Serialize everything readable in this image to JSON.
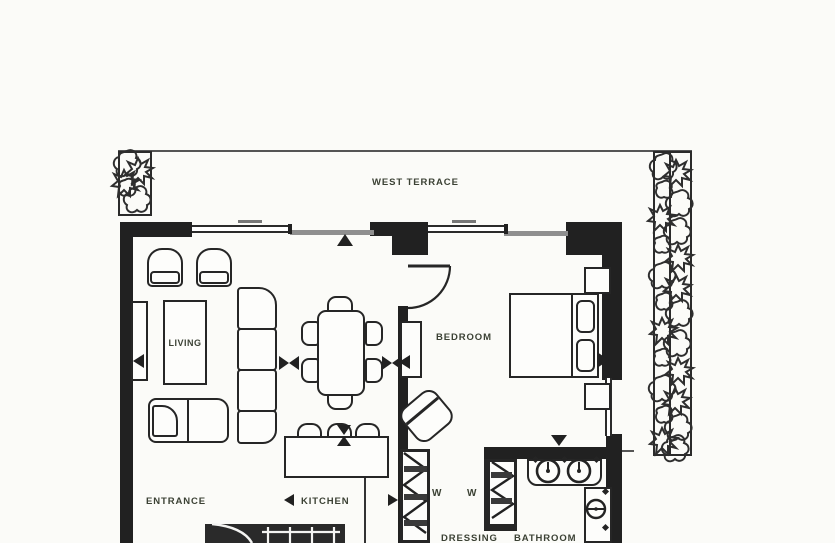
{
  "document": {
    "kind": "residential floor plan"
  },
  "labels": {
    "terrace": "WEST TERRACE",
    "living": "LIVING",
    "bedroom": "BEDROOM",
    "entrance": "ENTRANCE",
    "kitchen": "KITCHEN",
    "dressing": "DRESSING",
    "bathroom": "BATHROOM",
    "wardrobe_left": "W",
    "wardrobe_right": "W"
  },
  "colors": {
    "ink": "#242424",
    "wall": "#212121",
    "label_text": "#3b4134",
    "glass": "#8f8f8f",
    "background": "#fbfbf8"
  }
}
